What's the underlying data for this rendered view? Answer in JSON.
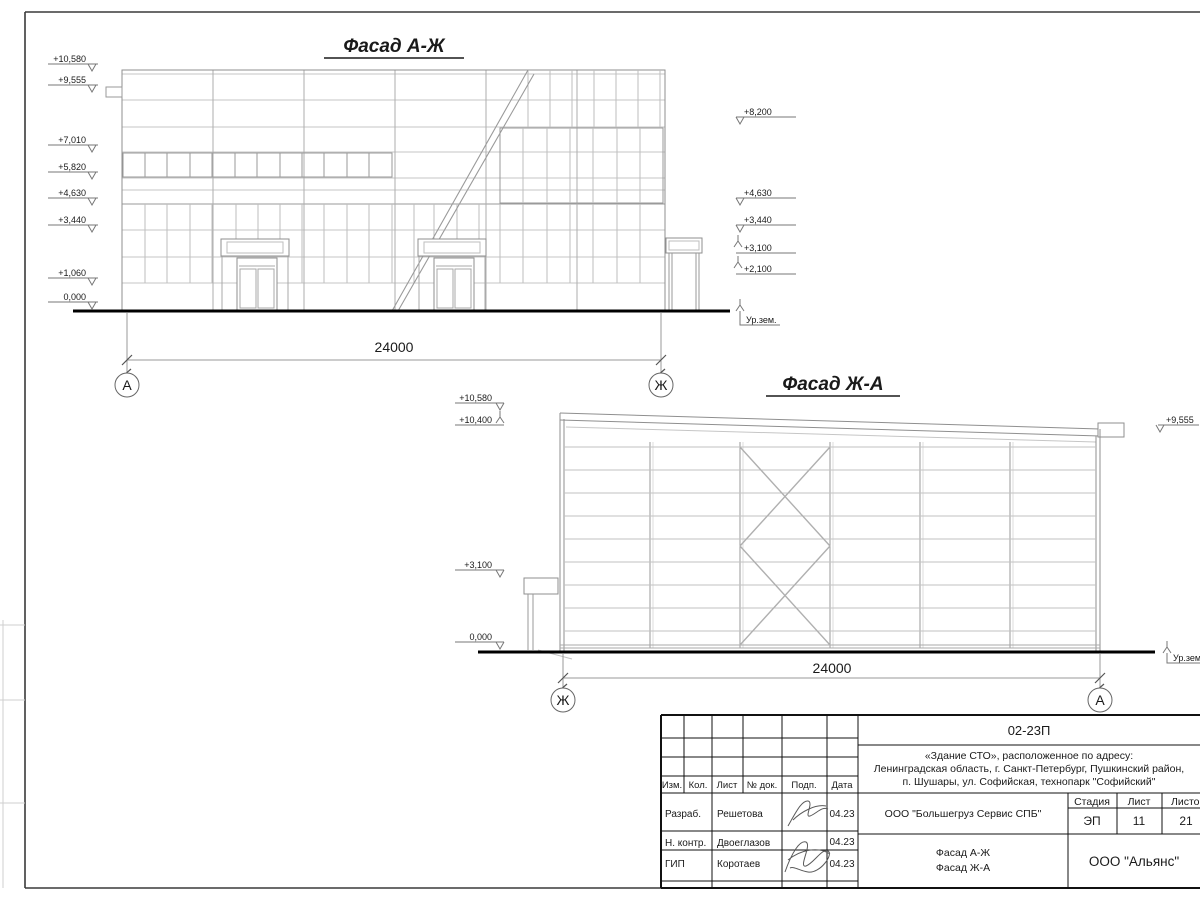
{
  "meta": {
    "colors": {
      "paper": "#ffffff",
      "linework": "#9a9a9a",
      "grid": "#c2c2c2",
      "ink": "#1a1a1a"
    }
  },
  "facade1": {
    "title": "Фасад А-Ж",
    "dimension": "24000",
    "axis_left": "А",
    "axis_right": "Ж",
    "marks_left": [
      "+10,580",
      "+9,555",
      "+7,010",
      "+5,820",
      "+4,630",
      "+3,440",
      "+1,060",
      "0,000"
    ],
    "marks_right": [
      "+8,200",
      "+4,630",
      "+3,440",
      "+3,100",
      "+2,100"
    ],
    "ground_label": "Ур.зем."
  },
  "facade2": {
    "title": "Фасад Ж-А",
    "dimension": "24000",
    "axis_left": "Ж",
    "axis_right": "А",
    "marks_left": [
      "+10,580",
      "+10,400",
      "+3,100",
      "0,000"
    ],
    "marks_right": [
      "+9,555"
    ],
    "ground_label": "Ур.зем."
  },
  "titleblock": {
    "doc_number": "02-23П",
    "project_line1": "«Здание СТО», расположенное по адресу:",
    "project_line2": "Ленинградская область, г. Санкт-Петербург, Пушкинский район,",
    "project_line3": "п. Шушары, ул. Софийская, технопарк \"Софийский\"",
    "header_cols": [
      "Изм.",
      "Кол.",
      "Лист",
      "№ док.",
      "Подп.",
      "Дата"
    ],
    "rows": [
      {
        "role": "Разраб.",
        "name": "Решетова",
        "date": "04.23"
      },
      {
        "role": "Н. контр.",
        "name": "Двоеглазов",
        "date": "04.23"
      },
      {
        "role": "ГИП",
        "name": "Коротаев",
        "date": "04.23"
      }
    ],
    "client": "ООО \"Большегруз Сервис СПБ\"",
    "stage_label": "Стадия",
    "sheet_label": "Лист",
    "sheets_label": "Листов",
    "stage": "ЭП",
    "sheet_no": "11",
    "sheets_total": "21",
    "drawing_title_line1": "Фасад А-Ж",
    "drawing_title_line2": "Фасад Ж-А",
    "company": "ООО \"Альянс\""
  }
}
